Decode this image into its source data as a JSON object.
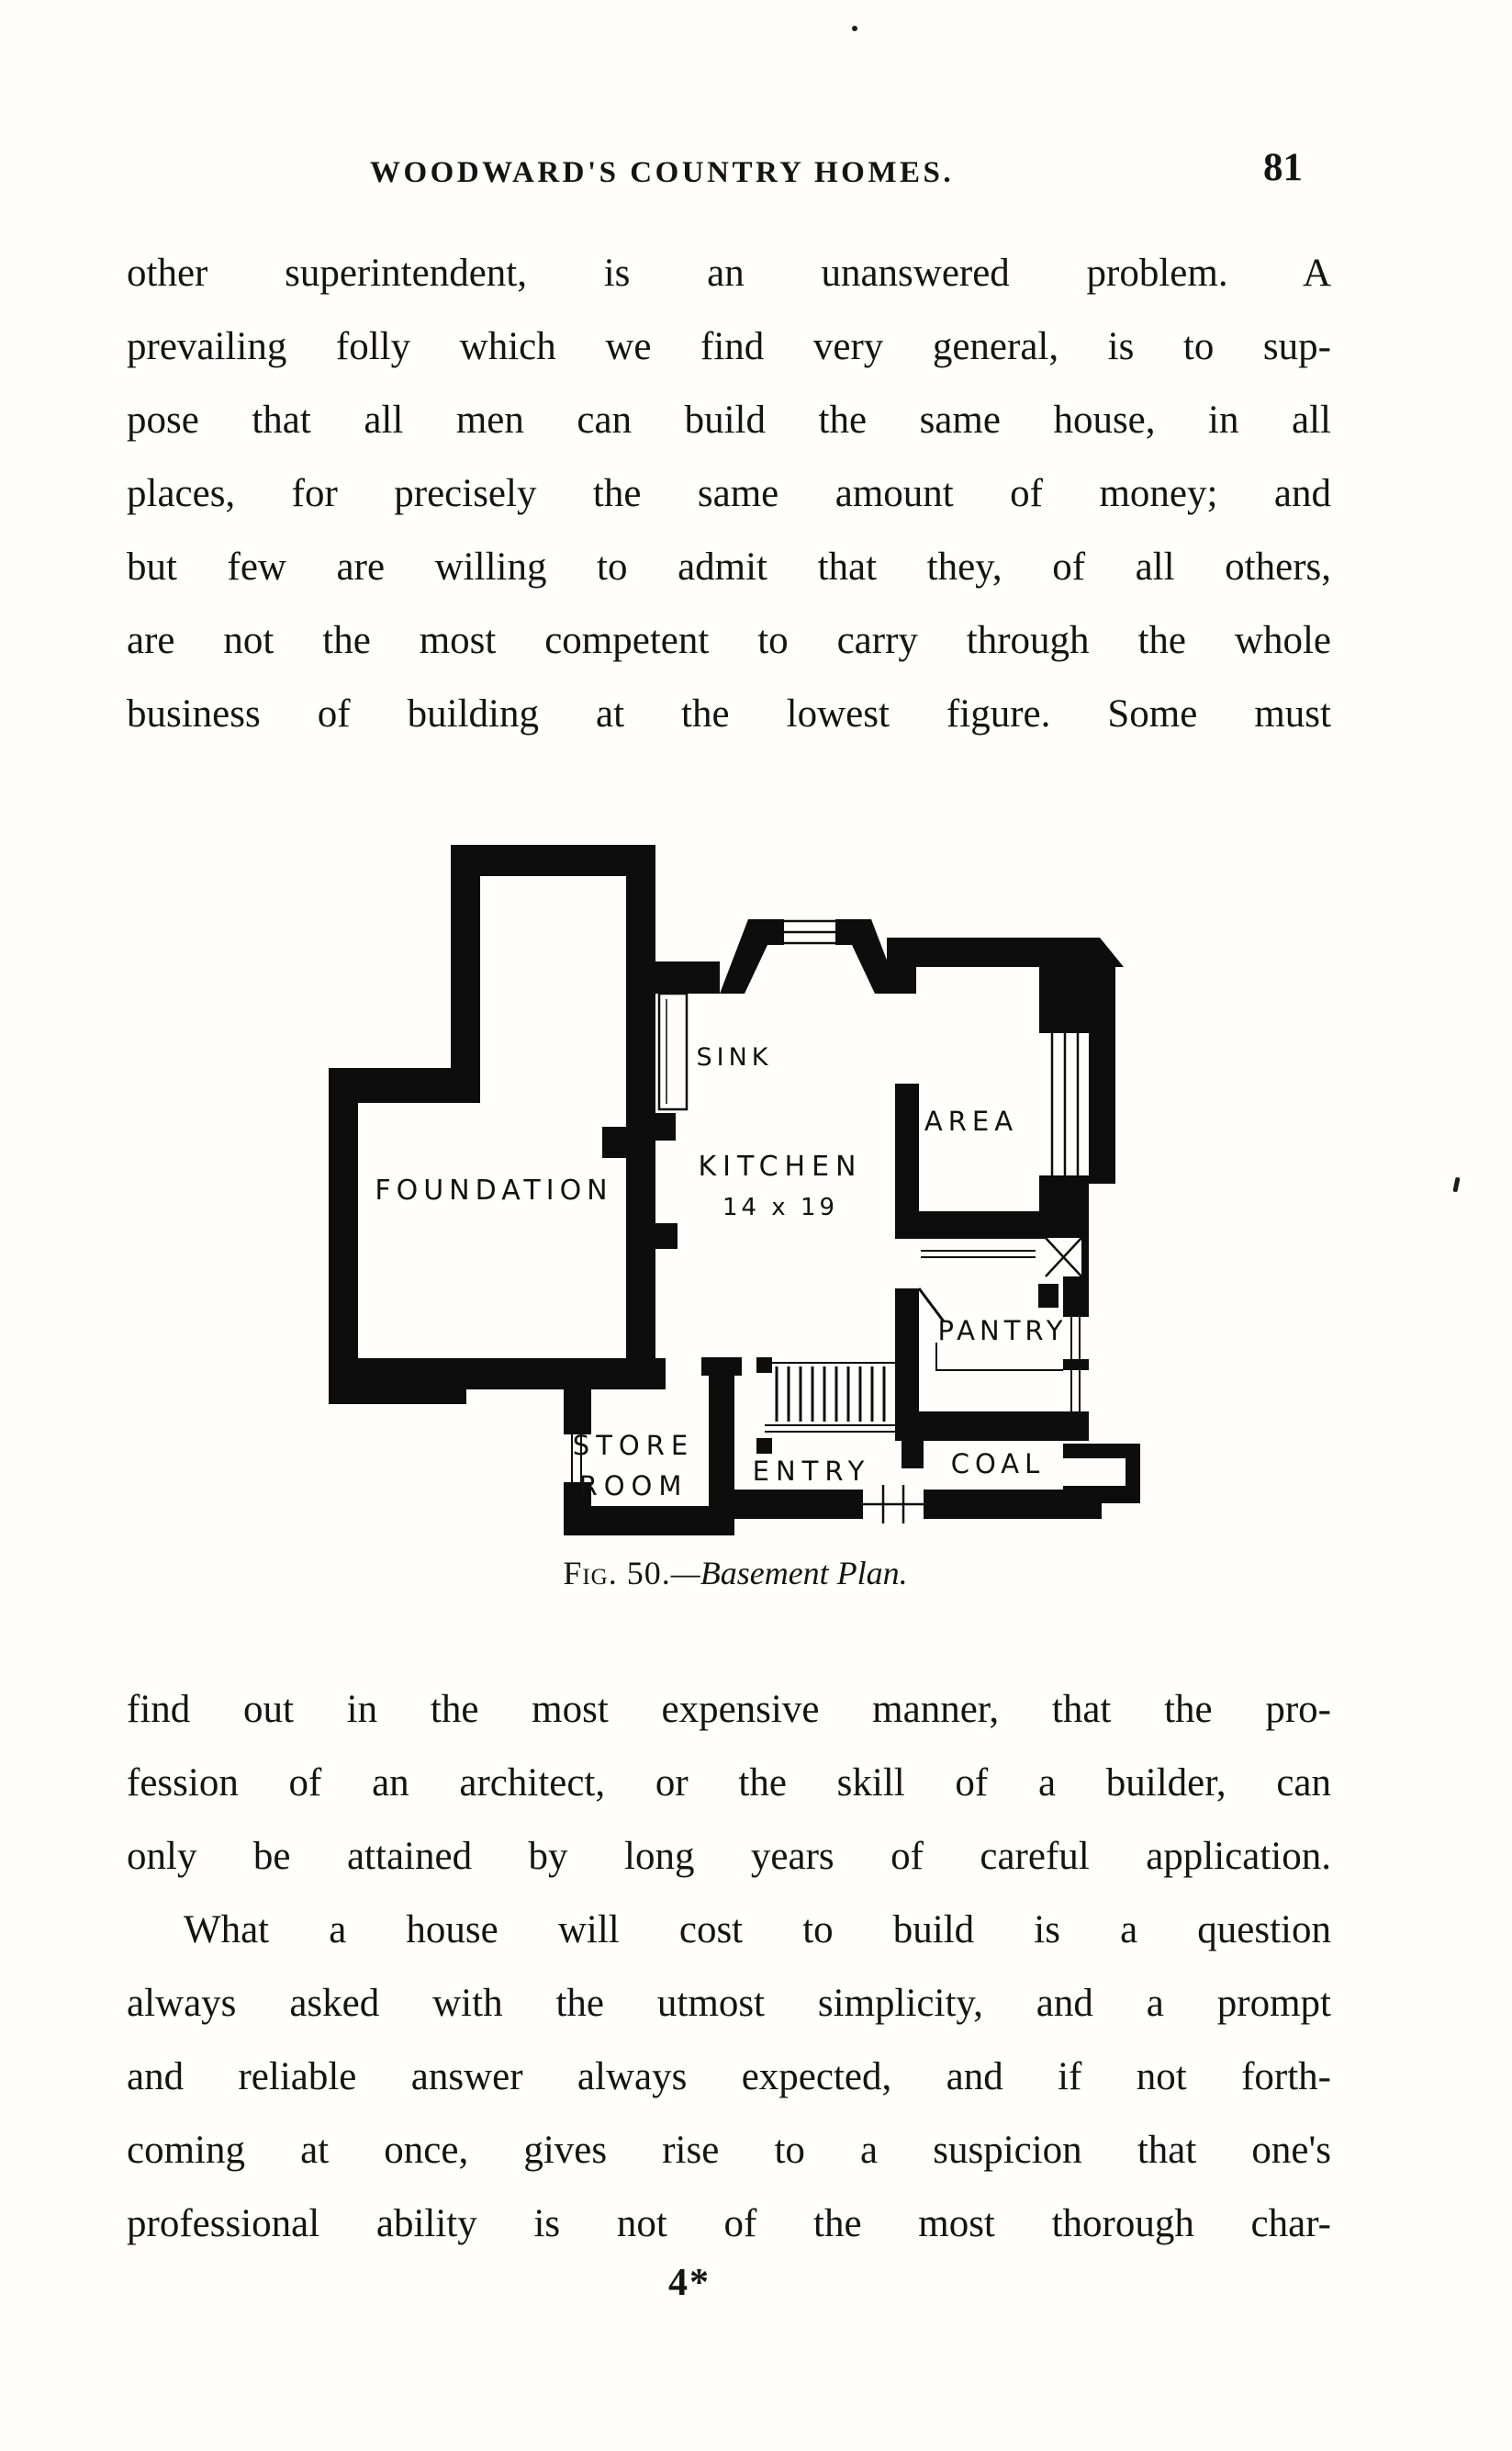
{
  "page": {
    "header": {
      "title": "WOODWARD'S COUNTRY HOMES.",
      "page_number": "81"
    },
    "paragraph1": {
      "lines": [
        "other superintendent, is an unanswered problem.  A",
        "prevailing folly which we find very general, is to sup-",
        "pose that all men can build the same house, in all",
        "places, for precisely the same amount of money; and",
        "but few are willing to admit that they, of all others,",
        "are not the most competent to carry through the whole",
        "business of building at the lowest figure.   Some must"
      ]
    },
    "figure": {
      "caption_prefix": "Fig. 50.",
      "caption_rest": "—Basement Plan.",
      "rooms": {
        "sink": "SINK",
        "kitchen": "KITCHEN",
        "kitchen_size": "14 x 19",
        "area": "AREA",
        "foundation": "FOUNDATION",
        "pantry": "PANTRY",
        "store_line1": "STORE",
        "store_line2": "ROOM",
        "entry": "ENTRY",
        "coal": "COAL"
      }
    },
    "paragraph2": {
      "lines": [
        "find out in the most expensive manner, that the pro-",
        "fession of an architect, or the skill of a builder, can",
        "only be attained by long years of careful application."
      ]
    },
    "paragraph3": {
      "lines": [
        "What a house will cost to build is a question",
        "always asked with the utmost simplicity, and a prompt",
        "and reliable answer always expected, and if not forth-",
        "coming at once, gives rise to a suspicion that one's",
        "professional ability is not of the most thorough char-"
      ]
    },
    "footer": {
      "signature": "4*"
    }
  }
}
